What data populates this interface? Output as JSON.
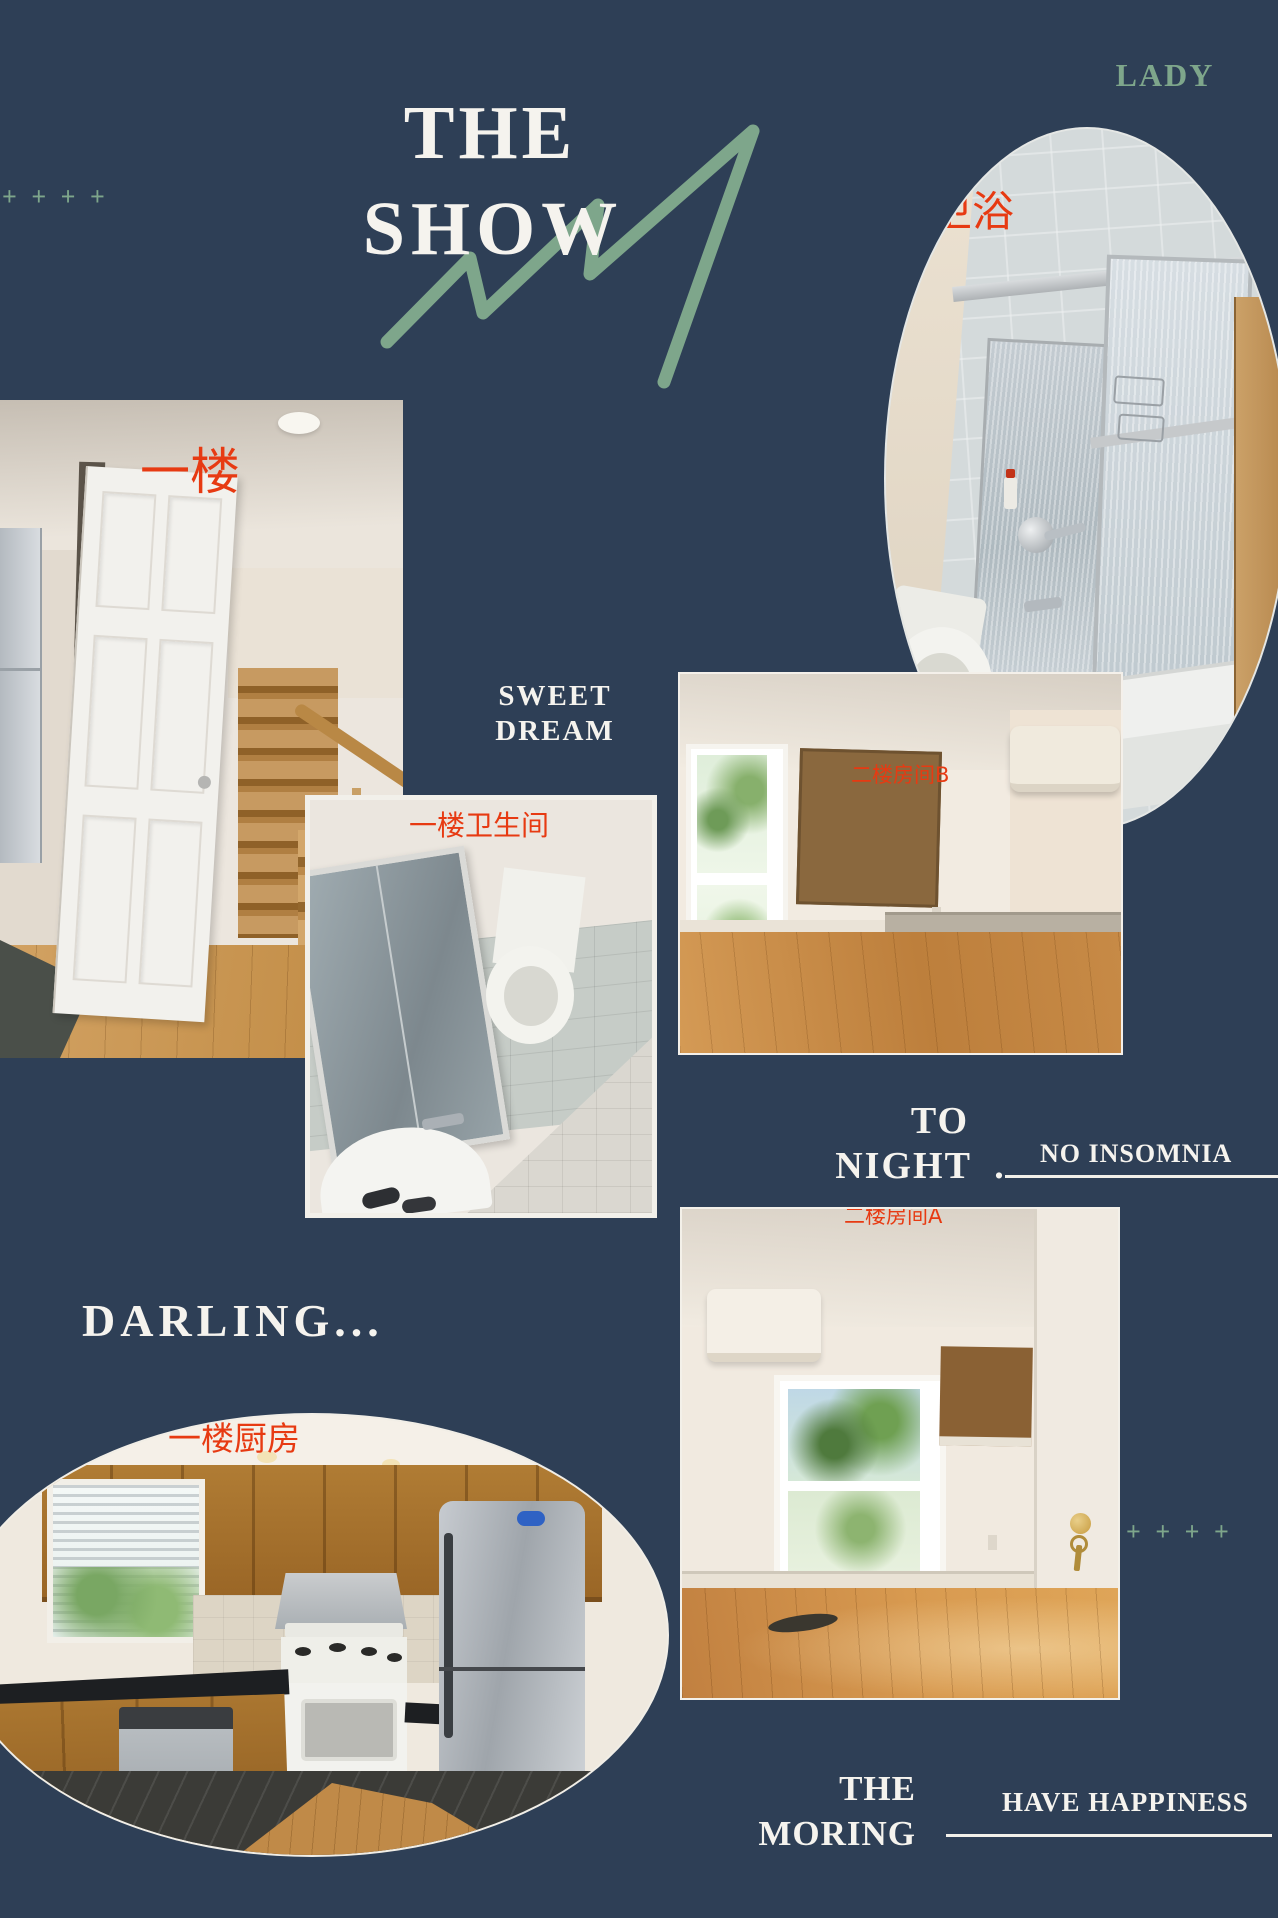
{
  "canvas": {
    "background": "#2e3f56"
  },
  "colors": {
    "accent_green": "#7ea68b",
    "label_red": "#e73a12",
    "text_white": "#f5f3ee"
  },
  "decor": {
    "plus_top_left": "+ + + +",
    "plus_bottom_right": "+ + + +"
  },
  "header": {
    "title_line1": "THE",
    "title_line2": "SHOW",
    "corner_text": "LADY"
  },
  "captions": {
    "sweet_line1": "SWEET",
    "sweet_line2": "DREAM",
    "tonight_line1": "TO",
    "tonight_line2": "NIGHT  .",
    "no_insomnia": "NO INSOMNIA",
    "darling": "DARLING...",
    "morning_line1": "THE",
    "morning_line2": "MORING",
    "have_happiness": "HAVE HAPPINESS"
  },
  "photos": [
    {
      "id": "master-bath",
      "label": "卫浴",
      "shape": "oval",
      "subject": "upstairs bathroom with glass shower doors, tub and toilet"
    },
    {
      "id": "first-floor-hall",
      "label": "一楼",
      "shape": "rect",
      "subject": "first floor hallway with open white door and wooden staircase"
    },
    {
      "id": "first-floor-bathroom",
      "label": "一楼卫生间",
      "shape": "rect",
      "subject": "first floor bathroom with mirror cabinet, sink and toilet"
    },
    {
      "id": "second-floor-room-b",
      "label": "二楼房间B",
      "shape": "rect",
      "subject": "empty bedroom B with window, cork board and AC unit"
    },
    {
      "id": "second-floor-room-a",
      "label": "二楼房间A",
      "shape": "rect",
      "subject": "empty bedroom A with window, door with keys and wood floor"
    },
    {
      "id": "first-floor-kitchen",
      "label": "一楼厨房",
      "shape": "oval",
      "subject": "kitchen with oak cabinets, white gas stove and stainless fridge"
    }
  ]
}
